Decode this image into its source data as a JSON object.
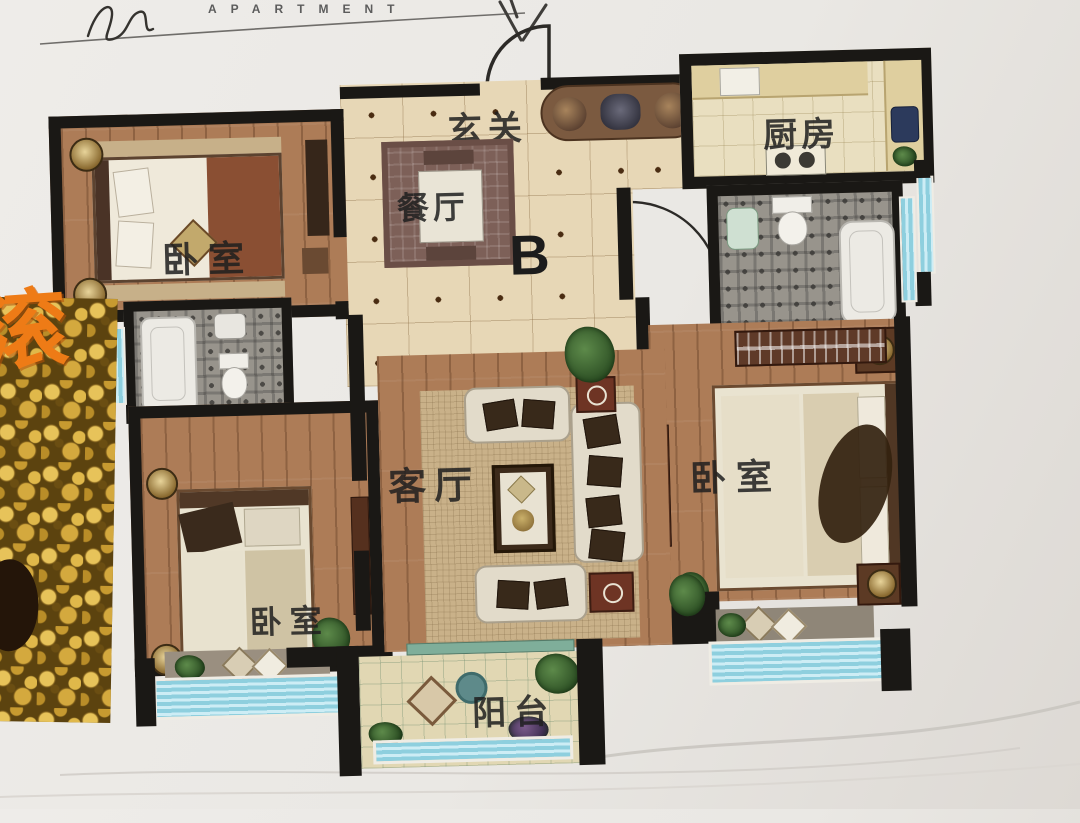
{
  "header": {
    "brand": "APARTMENT"
  },
  "unit_label": "B",
  "rooms": {
    "entrance": "玄关",
    "kitchen": "厨房",
    "dining": "餐厅",
    "living": "客厅",
    "bedroom_top_left": "卧室",
    "bedroom_bottom_left": "卧室",
    "bedroom_right": "卧室",
    "balcony": "阳台"
  },
  "overlay": {
    "character": "滚"
  },
  "colors": {
    "wall": "#1a1815",
    "tile_floor": "#e7d7b6",
    "wood_floor": "#ad7c57",
    "window_glass": "#8ecfde",
    "coin_gold": "#d4a93e",
    "overlay_character": "#ee7b16",
    "paper": "#eae8e4"
  }
}
